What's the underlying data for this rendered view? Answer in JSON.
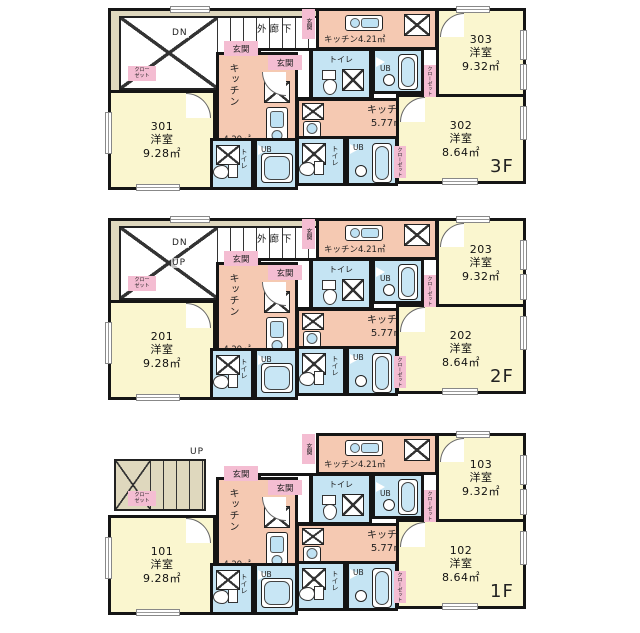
{
  "colors": {
    "wall": "#151515",
    "room": "#FAF6CF",
    "corridor": "#DFD8BE",
    "kitchen": "#F5C9B2",
    "wet": "#C5E4F3",
    "label_pink": "#F4BDD2"
  },
  "shared": {
    "entrance": "玄関",
    "toilet": "トイレ",
    "bath": "UB",
    "closet": "クローゼット",
    "closet_line1": "クロー",
    "closet_line2": "ゼット"
  },
  "floors": [
    {
      "floor_label": "3F",
      "floor_class": "floor floor-3f",
      "corridor_label": "外廊下",
      "stair_down": "DN",
      "stair_up": "",
      "units": [
        {
          "number": "301",
          "type": "洋室",
          "area": "9.28㎡"
        },
        {
          "number": "302",
          "type": "洋室",
          "area": "8.64㎡"
        },
        {
          "number": "303",
          "type": "洋室",
          "area": "9.32㎡"
        }
      ],
      "kitchens": {
        "side_label": "キッチン",
        "side_area": "4.29㎡",
        "main_label": "キッチン",
        "main_area": "5.77㎡",
        "upper": "キッチン4.21㎡"
      }
    },
    {
      "floor_label": "2F",
      "floor_class": "floor floor-2f",
      "corridor_label": "外廊下",
      "stair_down": "DN",
      "stair_up": "UP",
      "units": [
        {
          "number": "201",
          "type": "洋室",
          "area": "9.28㎡"
        },
        {
          "number": "202",
          "type": "洋室",
          "area": "8.64㎡"
        },
        {
          "number": "203",
          "type": "洋室",
          "area": "9.32㎡"
        }
      ],
      "kitchens": {
        "side_label": "キッチン",
        "side_area": "4.29㎡",
        "main_label": "キッチン",
        "main_area": "5.77㎡",
        "upper": "キッチン4.21㎡"
      }
    },
    {
      "floor_label": "1F",
      "floor_class": "floor floor-1f",
      "corridor_label": "",
      "stair_down": "",
      "stair_up": "UP",
      "units": [
        {
          "number": "101",
          "type": "洋室",
          "area": "9.28㎡"
        },
        {
          "number": "102",
          "type": "洋室",
          "area": "8.64㎡"
        },
        {
          "number": "103",
          "type": "洋室",
          "area": "9.32㎡"
        }
      ],
      "kitchens": {
        "side_label": "キッチン",
        "side_area": "4.29㎡",
        "main_label": "キッチン",
        "main_area": "5.77㎡",
        "upper": "キッチン4.21㎡"
      }
    }
  ]
}
